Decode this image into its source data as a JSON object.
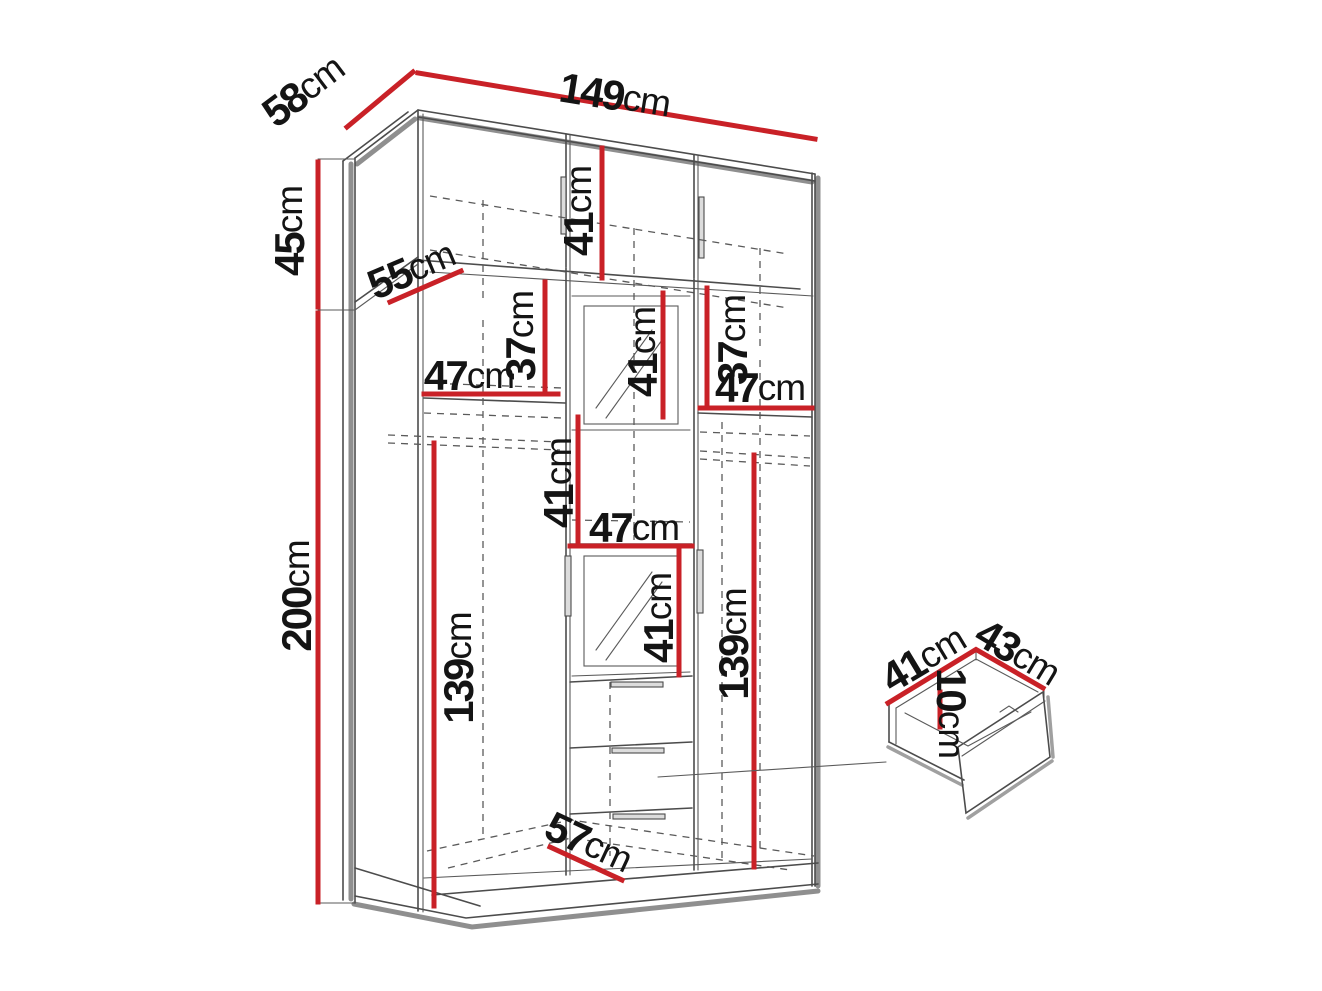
{
  "figure_title": "",
  "colors": {
    "dimension_red": "#c92127",
    "outline_gray": "#4c4c4c",
    "shadow_gray": "#8f8f8f",
    "label_black": "#141414",
    "background": "#ffffff"
  },
  "dims": {
    "depth": {
      "value": "58",
      "unit": "cm"
    },
    "width": {
      "value": "149",
      "unit": "cm"
    },
    "top_height": {
      "value": "45",
      "unit": "cm"
    },
    "main_height": {
      "value": "200",
      "unit": "cm"
    },
    "top_shelf_depth": {
      "value": "55",
      "unit": "cm"
    },
    "top_inner_height": {
      "value": "41",
      "unit": "cm"
    },
    "left_upper_gap": {
      "value": "37",
      "unit": "cm"
    },
    "left_shelf_width": {
      "value": "47",
      "unit": "cm"
    },
    "mid_upper_height": {
      "value": "41",
      "unit": "cm"
    },
    "right_upper_gap": {
      "value": "37",
      "unit": "cm"
    },
    "right_shelf_width": {
      "value": "47",
      "unit": "cm"
    },
    "mid_hang_height": {
      "value": "41",
      "unit": "cm"
    },
    "mid_shelf_width": {
      "value": "47",
      "unit": "cm"
    },
    "mirror_sect_height": {
      "value": "41",
      "unit": "cm"
    },
    "left_hang_height": {
      "value": "139",
      "unit": "cm"
    },
    "right_hang_height": {
      "value": "139",
      "unit": "cm"
    },
    "bottom_depth": {
      "value": "57",
      "unit": "cm"
    },
    "drawer_depth": {
      "value": "41",
      "unit": "cm"
    },
    "drawer_width": {
      "value": "43",
      "unit": "cm"
    },
    "drawer_height": {
      "value": "10",
      "unit": "cm"
    }
  }
}
